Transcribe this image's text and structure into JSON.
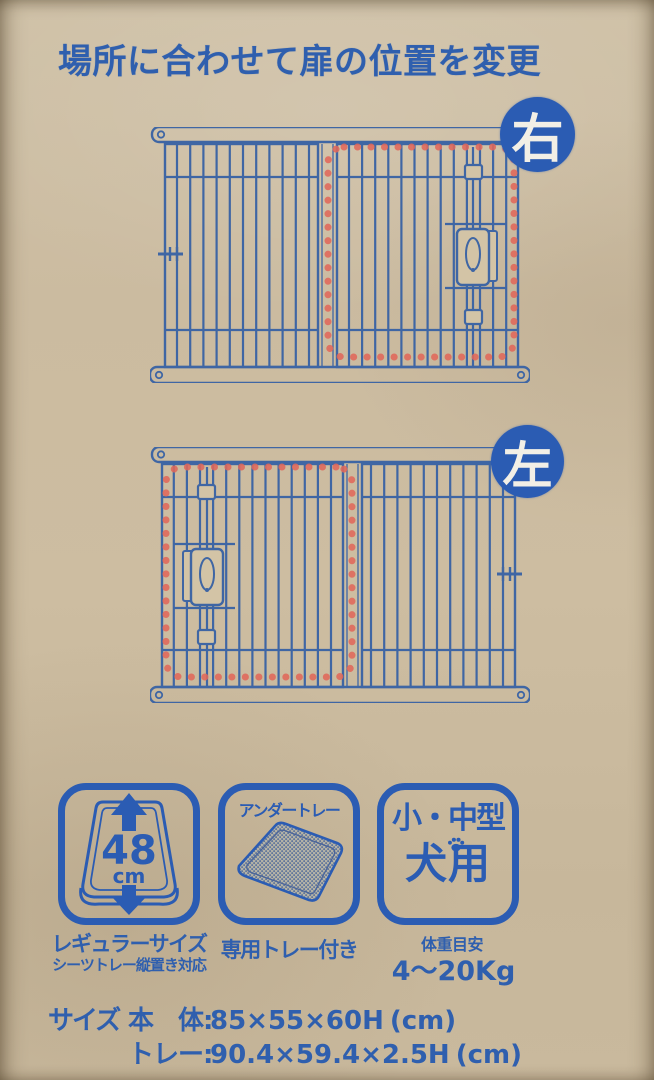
{
  "page": {
    "title": "場所に合わせて扉の位置を変更"
  },
  "diagrams": {
    "right": {
      "badge": "右",
      "door_side": "right"
    },
    "left": {
      "badge": "左",
      "door_side": "left"
    }
  },
  "features": {
    "size_icon": {
      "value": "48",
      "unit": "cm",
      "caption": "レギュラーサイズ",
      "subcaption": "シーツトレー縦置き対応"
    },
    "tray_icon": {
      "label": "アンダートレー",
      "caption": "専用トレー付き"
    },
    "dog_icon": {
      "line1": "小・中型",
      "line2": "犬用",
      "weight_label": "体重目安",
      "weight_value": "4〜20Kg"
    }
  },
  "size_table": {
    "label": "サイズ",
    "rows": [
      {
        "name": "本　体:",
        "value": "85×55×60H",
        "unit": "(cm)"
      },
      {
        "name": "トレー:",
        "value": "90.4×59.4×2.5H",
        "unit": "(cm)"
      }
    ]
  },
  "colors": {
    "ink": "#3f66a4",
    "text_blue": "#2f5fae",
    "badge_blue": "#2b5cb3",
    "dot_red": "#e0685a",
    "cardboard": "#c9baa0",
    "latch_fill": "#d3c4a6"
  }
}
